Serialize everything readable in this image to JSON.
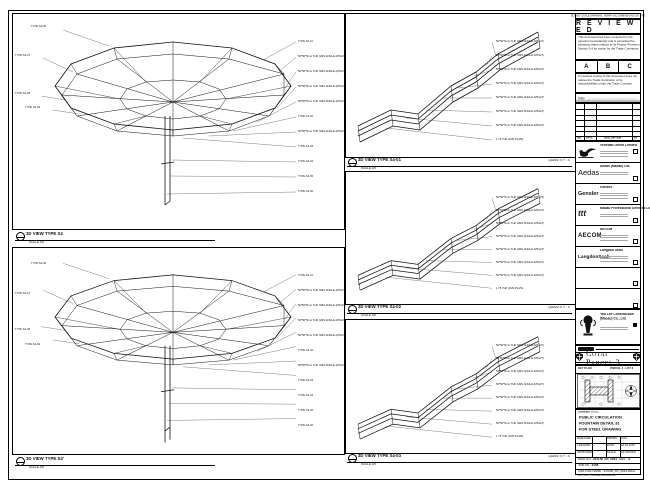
{
  "sheet": {
    "top_note": "DO NOT SCALE DRAWING. VERIFY ALL DIMENSIONS ON SITE."
  },
  "review": {
    "stamp": "R E V I E W E D",
    "para1": "This document has been reviewed by the relevant Consultant(s) and is accorded the following status relative to its Project Provision Section 5.4 for action by the Trade Contractor.",
    "grades": [
      "A",
      "B",
      "C"
    ],
    "para2": "Consultant review of this document does not relieve the Trade Contractor of its responsibilities under the Trade Contract.",
    "date_label": "Date :",
    "table_headers": [
      "NO.",
      "DATE",
      "DESCRIPTION",
      "BY"
    ]
  },
  "companies": [
    {
      "name": "Venetian Orient Limited",
      "logo_text": ""
    },
    {
      "name": "Aedas (Macau) Ltd.",
      "logo_text": "Aedas"
    },
    {
      "name": "Gensler",
      "logo_text": "Gensler"
    },
    {
      "name": "Macau Professional Services Ltd.",
      "logo_text": "ttt"
    },
    {
      "name": "AECOM",
      "logo_text": "AECOM"
    },
    {
      "name": "Langdon Seah",
      "logo_text": "LangdonSeah"
    },
    {
      "name": "",
      "logo_text": ""
    },
    {
      "name": "",
      "logo_text": ""
    }
  ],
  "contractor": {
    "name": "Yau Lee Construction (Macau) Co., Ltd."
  },
  "project": {
    "banner": "Cotai Parcel 3",
    "keyplan_label": "KEY PLAN",
    "keyplan_ref": "PARCEL 3 - LOT 2"
  },
  "titleblock": {
    "label": "DRAWING TITLE:",
    "title_lines": [
      "PUBLIC CIRCULATION",
      "FOUNTAIN DETAIL 31",
      "FOR STEEL DRAWING"
    ],
    "grid": [
      [
        "DESIGNED",
        "",
        "DRAWN",
        "CAD"
      ],
      [
        "CHECKED",
        "-",
        "DATE",
        "24-04-2015"
      ],
      [
        "APPROVED",
        "-",
        "SCALE",
        "AS SHOWN"
      ]
    ],
    "dwg_label": "DWG NO :",
    "dwg_no": "31SUB_FD_0034",
    "rev_label": "REV :",
    "rev": "A",
    "job_label": "JOB NO :",
    "job_no": "3158",
    "cad_label": "CAD FILE NAME :",
    "cad_file": "31SUB_FD_0034.DWG",
    "note": "DO NOT SCALE DRAWING"
  },
  "panels": {
    "left_top": {
      "title": "3D VIEW TYPE S4",
      "scale": "SCALE 1/8",
      "left_labels": [
        "TYPE S4-30",
        "TYPE S4-37",
        "TYPE S4-38",
        "TYPE S4-39"
      ],
      "right_labels": [
        "TYPE S4-31",
        "50*50*5mm THK GMS ANGLE (MS127)",
        "50*50*5mm THK GMS ANGLE (MS127)",
        "50*50*5mm THK GMS ANGLE (MS127)",
        "50*50*5mm THK GMS ANGLE (MS127)",
        "TYPE S4-32",
        "50*50*5mm THK GMS ANGLE (MS127)",
        "TYPE S4-33",
        "TYPE S4-34",
        "TYPE S4-35",
        "TYPE S4-36"
      ]
    },
    "left_bottom": {
      "title": "3D VIEW TYPE S4'",
      "scale": "SCALE 1/8",
      "left_labels": [
        "TYPE S4-40",
        "TYPE S4-47",
        "TYPE S4-48",
        "TYPE S4-49"
      ],
      "right_labels": [
        "TYPE S4-41",
        "50*50*5mm THK GMS ANGLE (MS127)",
        "50*50*5mm THK GMS ANGLE (MS127)",
        "50*50*5mm THK GMS ANGLE (MS127)",
        "50*50*5mm THK GMS ANGLE (MS127)",
        "TYPE S4-42",
        "50*50*5mm THK GMS ANGLE (MS127)",
        "TYPE S4-43",
        "TYPE S4-44",
        "TYPE S4-45",
        "TYPE S4-46"
      ]
    },
    "mid_top": {
      "title": "3D VIEW TYPE S4-01",
      "scale": "SCALE 1/8",
      "quantity": "QUANTITY : 4",
      "right_labels": [
        "50*50*5mm THK GMS ANGLE (MS127)",
        "50*50*5mm THK GMS ANGLE (MS127)",
        "50*50*5mm THK GMS ANGLE (MS127)",
        "50*50*5mm THK GMS ANGLE (MS127)",
        "50*50*5mm THK GMS ANGLE (MS127)",
        "50*50*5mm THK GMS ANGLE (MS127)",
        "50*50*5mm THK GMS ANGLE (MS127)",
        "1.75 THK GMS PLATE"
      ]
    },
    "mid_mid": {
      "title": "3D VIEW TYPE S4-02",
      "scale": "SCALE 1/8",
      "quantity": "QUANTITY : 4",
      "right_labels": [
        "50*50*5mm THK GMS ANGLE (MS127)",
        "50*50*5mm THK GMS ANGLE (MS127)",
        "50*50*5mm THK GMS ANGLE (MS127)",
        "50*50*5mm THK GMS ANGLE (MS127)",
        "50*50*5mm THK GMS ANGLE (MS127)",
        "50*50*5mm THK GMS ANGLE (MS127)",
        "50*50*5mm THK GMS ANGLE (MS127)",
        "1.75 THK GMS PLATE"
      ]
    },
    "mid_bot": {
      "title": "3D VIEW TYPE S4-03",
      "scale": "SCALE 1/8",
      "quantity": "QUANTITY : 4",
      "right_labels": [
        "50*50*5mm THK GMS ANGLE (MS127)",
        "50*50*5mm THK GMS ANGLE (MS127)",
        "50*50*5mm THK GMS ANGLE (MS127)",
        "50*50*5mm THK GMS ANGLE (MS127)",
        "50*50*5mm THK GMS ANGLE (MS127)",
        "50*50*5mm THK GMS ANGLE (MS127)",
        "50*50*5mm THK GMS ANGLE (MS127)",
        "1.75 THK GMS PLATE"
      ]
    }
  }
}
